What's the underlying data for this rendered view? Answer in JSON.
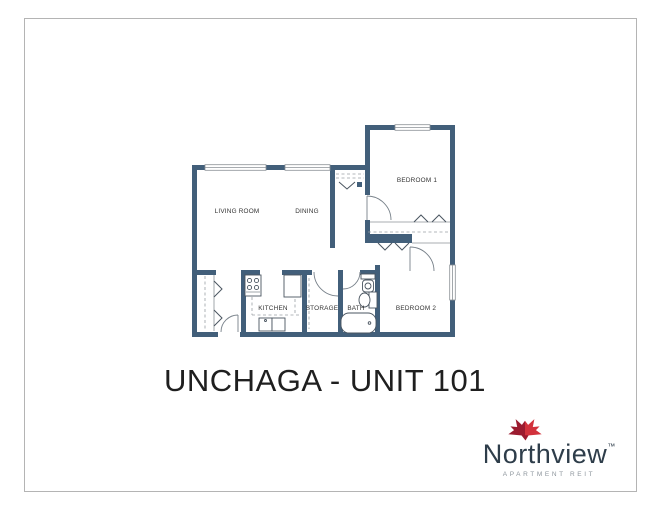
{
  "theme": {
    "wall": "#425f7a",
    "line": "#8b9196",
    "fixture": "#4a5560",
    "frame": "#b4b4b4",
    "title": "#1f1f1f",
    "brand": "#2e3d4a",
    "tagline": "#8d959c"
  },
  "floor_plan": {
    "rooms": [
      {
        "label": "LIVING ROOM"
      },
      {
        "label": "DINING"
      },
      {
        "label": "BEDROOM 1"
      },
      {
        "label": "BEDROOM 2"
      },
      {
        "label": "KITCHEN"
      },
      {
        "label": "STORAGE"
      },
      {
        "label": "BATH"
      }
    ]
  },
  "title": {
    "text": "UNCHAGA - UNIT 101"
  },
  "logo": {
    "brand": "Northview",
    "trademark": "™",
    "tagline": "APARTMENT REIT",
    "leaf_dark": "#9b1b2f",
    "leaf_light": "#d2323c"
  }
}
